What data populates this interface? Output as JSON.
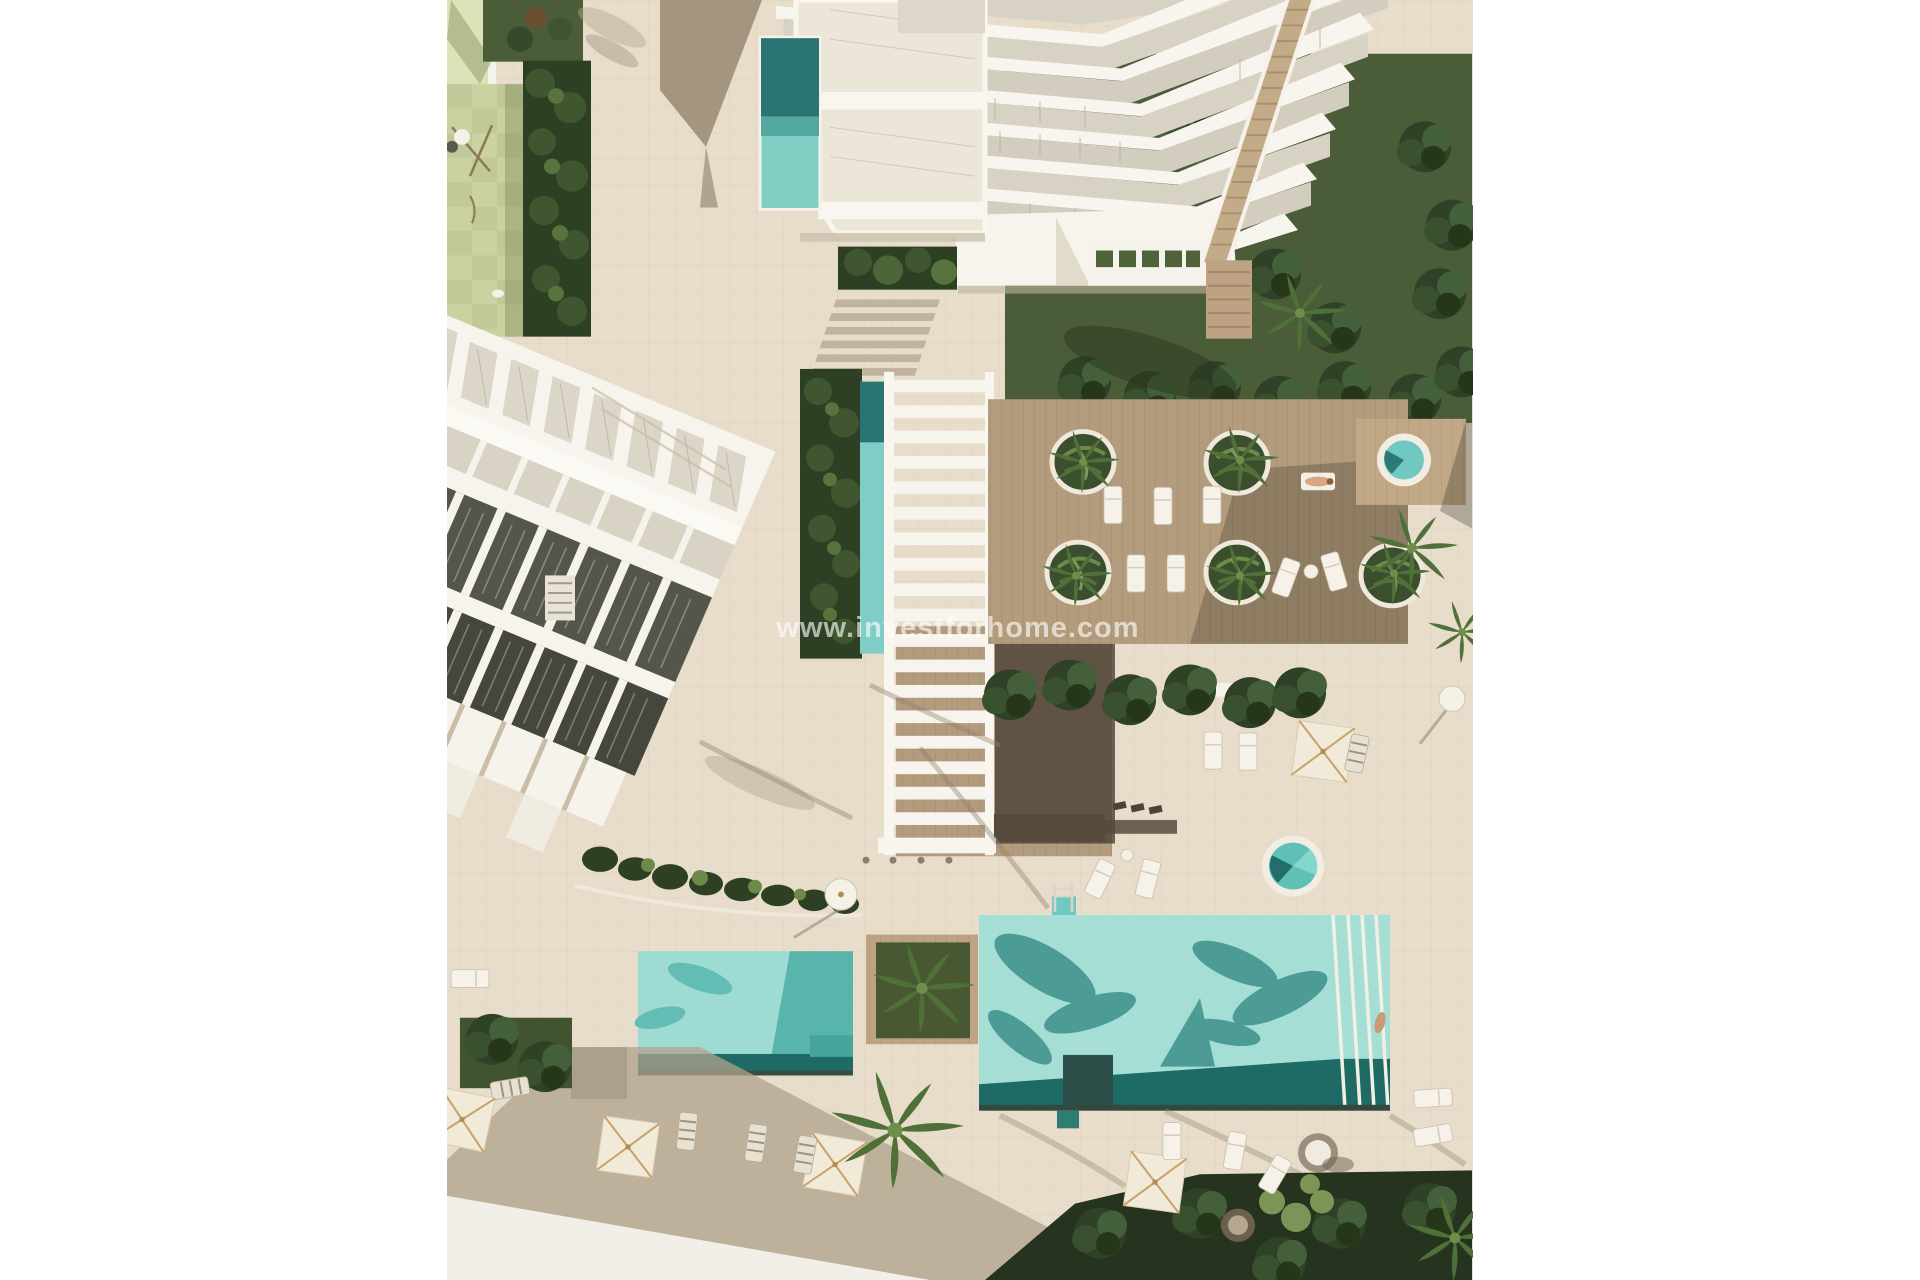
{
  "page": {
    "background_color": "#ffffff"
  },
  "photo": {
    "kind": "aerial 3d architectural render of residential resort complex",
    "watermark_text": "www.investforhome.com",
    "watermark_color": "rgba(255,255,255,0.62)",
    "palette": {
      "pavement": "#e7ddca",
      "building_white": "#f7f4ee",
      "glass": "#d8d2c4",
      "roof_dark": "#55564b",
      "window_dark": "#3c3d34",
      "lawn_green": "#55663f",
      "hedge_green": "#2e4023",
      "playground_green": "#ccd1a2",
      "pool_teal_light": "#9adcd2",
      "pool_teal_dark": "#1f6b66",
      "deck_wood": "#b39b7d",
      "shadow_warm": "#a4967e"
    },
    "features": {
      "rectangular_pools": 3,
      "round_plunge_pools": 2,
      "circular_planters": 5,
      "open_parasols": 5,
      "closed_parasols": 2,
      "residential_buildings": 2
    }
  }
}
